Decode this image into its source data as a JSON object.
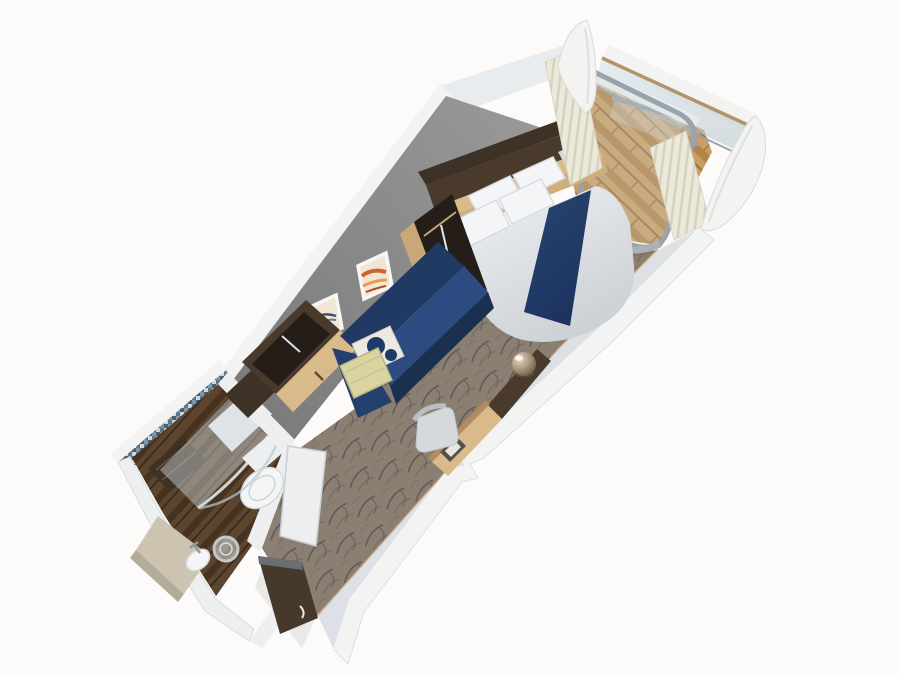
{
  "scene": {
    "description": "3D cutaway rendering of a cruise-ship balcony stateroom floor plan",
    "background": "#fcfbf9"
  },
  "colors": {
    "hull_white": "#f3f3f1",
    "band_white": "#eef0f0",
    "cornice_white": "#e9ecee",
    "wall_gray_dark": "#767676",
    "wall_gray_light": "#9a9a9a",
    "right_wall_face": "#dde1e5",
    "carpet_base": "#8b7f72",
    "carpet_swirl_dark": "#524b56",
    "carpet_swirl_mid": "#6e6357",
    "balcony_wood": "#c89e66",
    "balcony_wood_dark": "#b28549",
    "balcony_seam": "#9c7440",
    "bath_wood": "#5c452f",
    "bath_wood_dark": "#46321f",
    "mosaic_blue": "#7f98a9",
    "mosaic_dark": "#4a5f70",
    "mosaic_light": "#cfd7dc",
    "mosaic_mid": "#5d7689",
    "glass_tint": "#cddae0",
    "frame_gray": "#9aa3ab",
    "rail_wood": "#b2946a",
    "curtain_light": "#ece8da",
    "curtain_shade": "#d6d1bd",
    "duvet_light": "#f0f2f4",
    "duvet_shade": "#ccd1d6",
    "pillow_white": "#f4f5f7",
    "pillow_shadow": "#d8dbe0",
    "runner_navy": "#1d3461",
    "sofa_back_navy": "#203a63",
    "sofa_seat_navy": "#2c4b80",
    "sofa_front_navy": "#19304f",
    "sofa_arm_navy": "#24406e",
    "pillow_cream": "#d9d4a0",
    "pillow_cream_shade": "#b9b481",
    "pillow_pattern_bg": "#ece9e0",
    "pillow_pattern_navy": "#1d3a6b",
    "wood_dark_top": "#3e3126",
    "wood_dark": "#4a3a2b",
    "wood_dark_deep": "#241d18",
    "wood_light": "#d9ba8a",
    "wood_light_2": "#cfae7e",
    "wood_side": "#c8a878",
    "baseboard_wood": "#c9ad83",
    "door_brown": "#46382a",
    "door_edge_gray": "#6b6f74",
    "bath_white": "#eceeef",
    "fixture_white": "#f3f5f6",
    "counter_beige": "#cdc3b1",
    "counter_edge": "#b5ab99",
    "metal_gray": "#8f979c",
    "art_paper": "#f1e6d4",
    "art_orange_1": "#d2622a",
    "art_orange_2": "#e89a55",
    "art_orange_3": "#b8441f",
    "art_ink_navy": "#2c3e66",
    "art_ink_navy_2": "#46587e",
    "chair_gray": "#d6d9dc",
    "chair_back_gray": "#b9bec2",
    "hatch_dark": "#565049",
    "hatch_inner": "#e8e6e2",
    "desk_front": "#b08d5f"
  },
  "parts": [
    "balcony",
    "balustrade",
    "hull-fin-left",
    "hull-fin-right",
    "balcony-door",
    "curtains",
    "bed",
    "bed-runner",
    "pillows",
    "overhead-cabinet",
    "headboard",
    "bedside-table",
    "shelf-unit",
    "sofa",
    "sofa-pillows",
    "artworks",
    "wardrobe",
    "carpet",
    "desk",
    "desk-chair",
    "stool-ball",
    "bathroom",
    "shower",
    "toilet",
    "sink",
    "mirror",
    "entry-door",
    "bathroom-door",
    "left-wall",
    "right-wall"
  ]
}
